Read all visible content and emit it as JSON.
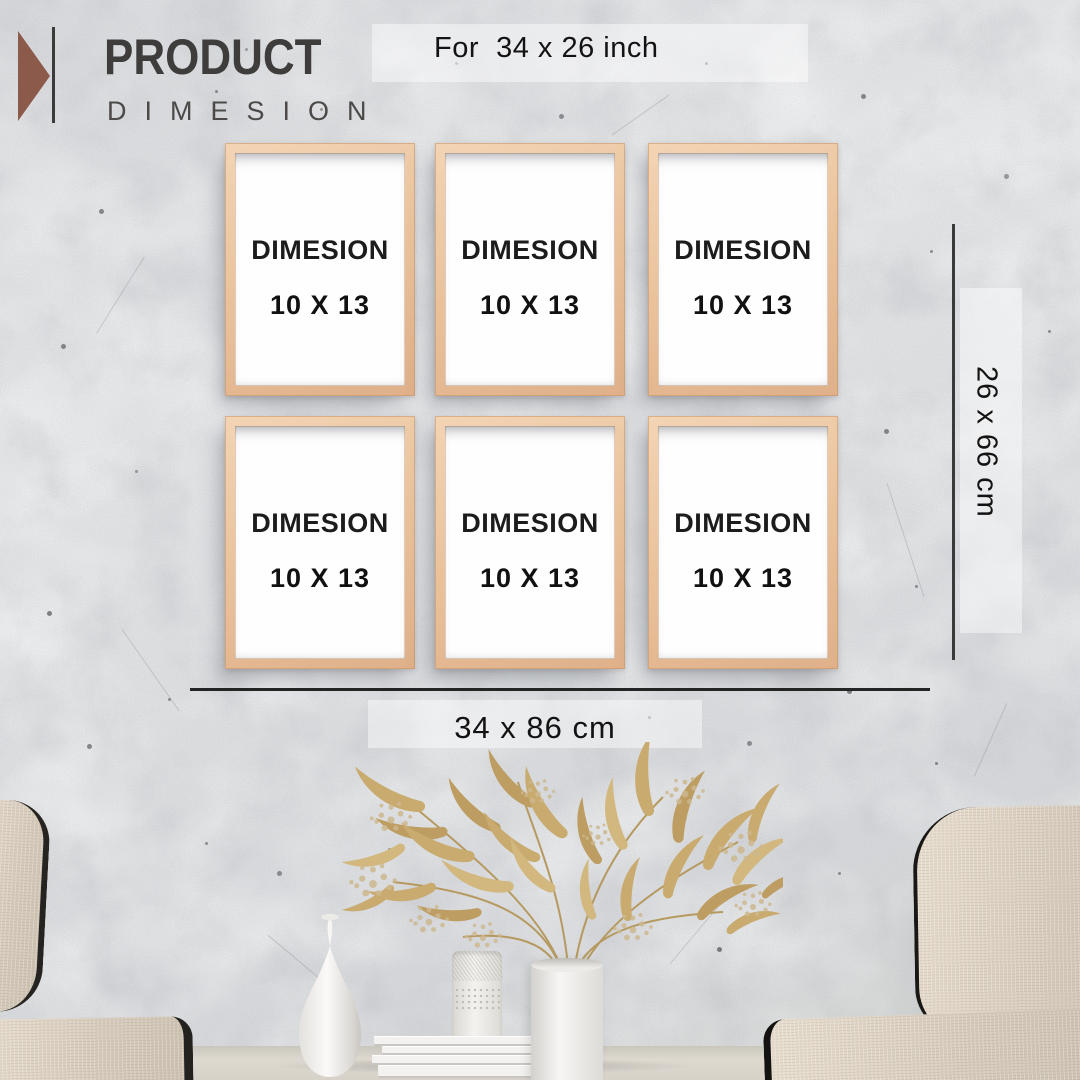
{
  "header": {
    "title": "PRODUCT",
    "subtitle": "DIMESION",
    "size_note": "For  34 x 26 inch"
  },
  "frames": {
    "items": [
      {
        "label": "DIMESION",
        "size": "10 X 13"
      },
      {
        "label": "DIMESION",
        "size": "10 X 13"
      },
      {
        "label": "DIMESION",
        "size": "10 X 13"
      },
      {
        "label": "DIMESION",
        "size": "10 X 13"
      },
      {
        "label": "DIMESION",
        "size": "10 X 13"
      },
      {
        "label": "DIMESION",
        "size": "10 X 13"
      }
    ]
  },
  "dimensions": {
    "height_label": "26 x 66 cm",
    "width_label": "34 x 86 cm"
  },
  "colors": {
    "accent_brown": "#8b5a4a",
    "frame_wood": "#eac49e",
    "wall_gray": "#dfe1e4",
    "plant_gold": "#c9ab70",
    "fabric_beige": "#d9cec0",
    "dimension_line": "#2e2e2e"
  },
  "icons": [
    {
      "name": "brand-triangle-icon",
      "shape": "right-pointing-triangle",
      "color": "#8b5a4a"
    }
  ]
}
